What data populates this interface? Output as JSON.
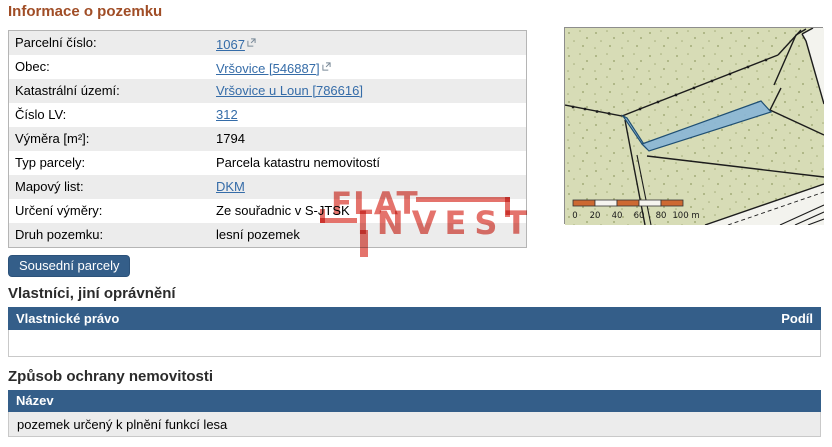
{
  "title": "Informace o pozemku",
  "info": {
    "rows": [
      {
        "label": "Parcelní číslo:",
        "value": "1067"
      },
      {
        "label": "Obec:",
        "value": "Vršovice [546887]"
      },
      {
        "label": "Katastrální území:",
        "value": "Vršovice u Loun [786616]"
      },
      {
        "label": "Číslo LV:",
        "value": "312"
      },
      {
        "label": "Výměra [m²]:",
        "value": "1794"
      },
      {
        "label": "Typ parcely:",
        "value": "Parcela katastru nemovitostí"
      },
      {
        "label": "Mapový list:",
        "value": "DKM"
      },
      {
        "label": "Určení výměry:",
        "value": "Ze souřadnic v S-JTSK"
      },
      {
        "label": "Druh pozemku:",
        "value": "lesní pozemek"
      }
    ]
  },
  "button": {
    "label": "Sousední parcely"
  },
  "owners": {
    "heading": "Vlastníci, jiní oprávnění",
    "col_left": "Vlastnické právo",
    "col_right": "Podíl",
    "rows": []
  },
  "protection": {
    "heading": "Způsob ochrany nemovitosti",
    "col": "Název",
    "row": "pozemek určený k plnění funkcí lesa"
  },
  "watermark": {
    "line1": "FLAT",
    "line2": "INVEST"
  },
  "map": {
    "description": "cadastral map with highlighted blue parcel on green forest land",
    "scale": {
      "labels": [
        "0",
        "20",
        "40",
        "60",
        "80",
        "100 m"
      ]
    }
  },
  "colors": {
    "title": "#a04d26",
    "link": "#356ca8",
    "header-bar": "#345e89",
    "button-bg": "#345e89",
    "watermark": "#e4736c",
    "row-alt": "#ececec",
    "map-land": "#d7dcb6",
    "map-parcel-fill": "#8ab5d6",
    "map-parcel-stroke": "#1f4f73",
    "map-scale-orange": "#cd6932",
    "map-line": "#1c1c1c"
  }
}
